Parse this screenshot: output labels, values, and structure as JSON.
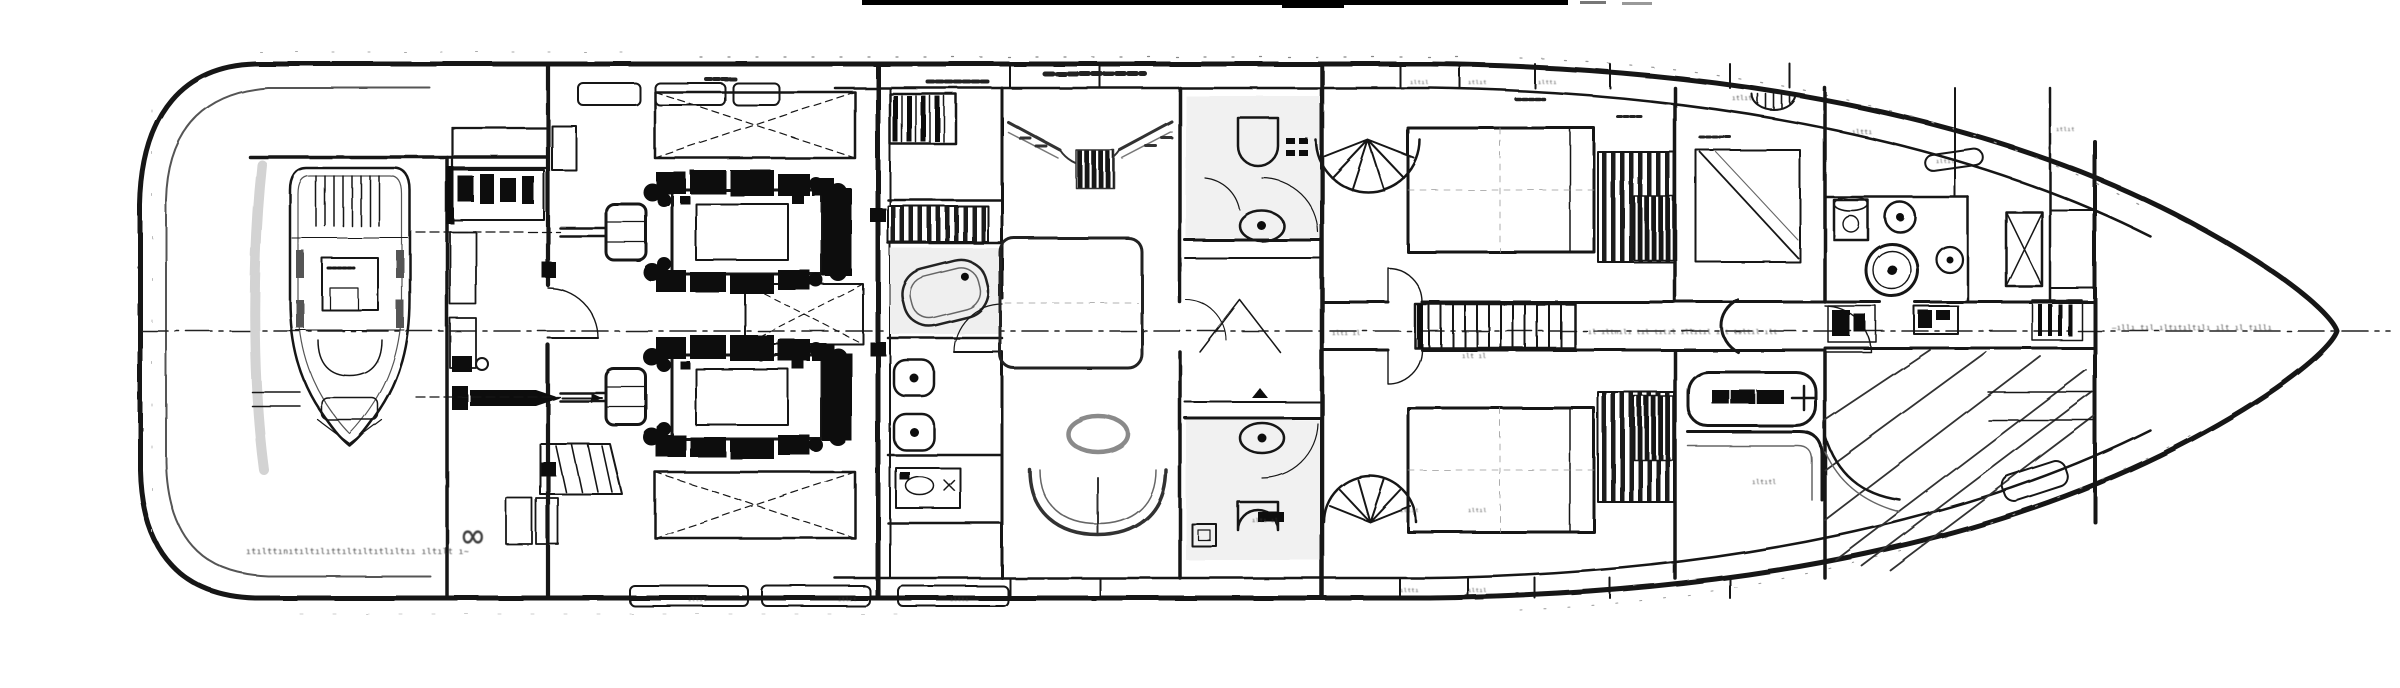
{
  "document": {
    "kind": "scanned hand-drawn yacht lower-deck general-arrangement plan",
    "orientation": "stern at left, bow at right, centerline horizontal",
    "title": ""
  },
  "colors": {
    "paper": "#ffffff",
    "ink": "#161616",
    "pencil": "#4c4c4c",
    "light_pencil": "#999999",
    "shade": "#e9e9e9"
  },
  "plan": {
    "compartments": [
      "tender-garage-with-tender",
      "lazarette-technical-space",
      "engine-room-twin-engines",
      "fuel-tanks-hatched",
      "master-suite-with-bath-column",
      "master-en-suite-bathrooms",
      "guest-cabin-upper",
      "guest-cabin-lower",
      "corridor-with-staircase",
      "crew-cabin-and-mess",
      "laundry-utility-room",
      "bow-storage-forepeak"
    ]
  },
  "annotations": {
    "garage_note": "ıtılttınıtıltılıttıltıltıtlıltıı ıltılt ı~",
    "infinity_mark": "∞",
    "corridor_note": "ıl ıltnılı tıl tıtıl ıllıtıl ılt tıltıl ılt",
    "corridor_note_small": "ıltı ıl",
    "stair_note": "ılt ıl",
    "bow_note": "—ıllı tıl ıltıtıltılı ılt ıl tıllı",
    "mess_label": "ıltıtl",
    "bath_label": "ıltı ıl",
    "tiny_label_a": "ıltıl",
    "tiny_label_b": "ıtlıt",
    "tiny_label_c": "ılttı"
  }
}
